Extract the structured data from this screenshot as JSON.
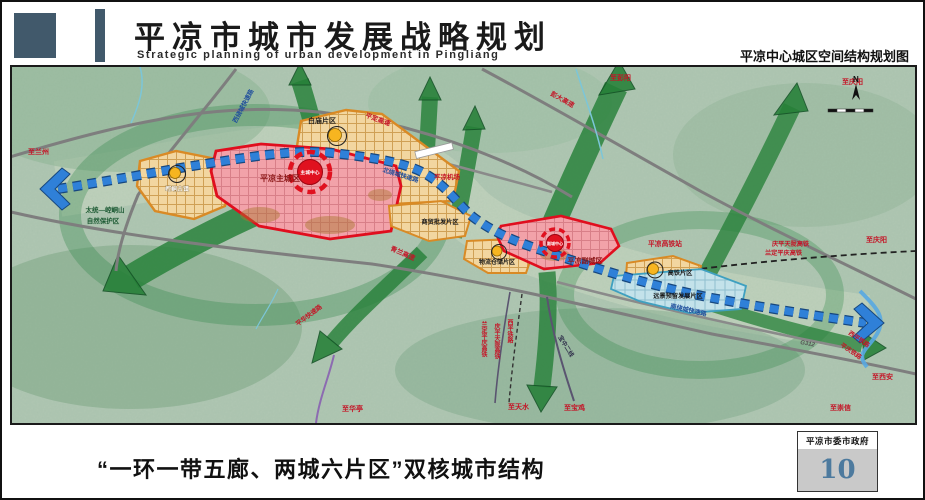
{
  "header": {
    "title": "平凉市城市发展战略规划",
    "subtitle_en": "Strategic planning of urban development in Pingliang",
    "right_title": "平凉中心城区空间结构规划图"
  },
  "footer": {
    "caption": "“一环一带五廊、两城六片区”双核城市结构",
    "agency": "平凉市委市政府",
    "page_number": "10"
  },
  "map": {
    "compass": "N",
    "zones": {
      "baimiao": "白庙片区",
      "kongtong": "崆峒古镇",
      "main_city": "平凉主城区",
      "main_center": "主城中心",
      "trade": "商贸批发片区",
      "logistics": "物流仓储片区",
      "sub_city": "平凉副城区",
      "sub_center": "副城中心",
      "hsr_zone": "高铁片区",
      "reserve": "远景预留发展片区"
    },
    "roads": {
      "xirao": "西绕城快速路",
      "beirao": "北绕城快速路",
      "nanrao": "南绕城快速路",
      "pinghua": "平华快速路",
      "pingding": "平定高速",
      "pengda": "彭大高速",
      "qinglan": "青兰高速",
      "g312": "G312"
    },
    "rails": {
      "qptl": "庆平天陇高铁",
      "ldpq": "兰定平庆高铁",
      "xiping": "西平铁路",
      "pingqing": "平庆铁路",
      "baozhong": "宝中二线",
      "hsr_station": "平凉高铁站"
    },
    "poi": {
      "airport": "平凉机场",
      "nature_reserve_1": "太统—崆峒山",
      "nature_reserve_2": "自然保护区"
    },
    "directions": {
      "lanzhou": "至兰州",
      "pengyang": "至彭阳",
      "qingyang": "至庆阳",
      "xian": "至西安",
      "chongxin": "至崇信",
      "baoji": "至宝鸡",
      "tianshui": "至天水",
      "huating": "至华亭"
    },
    "colors": {
      "corridor_green": "#268038",
      "belt_blue": "#2f80d8",
      "zone_red": "#e00e1e",
      "zone_orange": "#d98a25",
      "zone_blue": "#3fa0c0",
      "label_red": "#c41426",
      "label_blue": "#1f4e9c"
    }
  }
}
